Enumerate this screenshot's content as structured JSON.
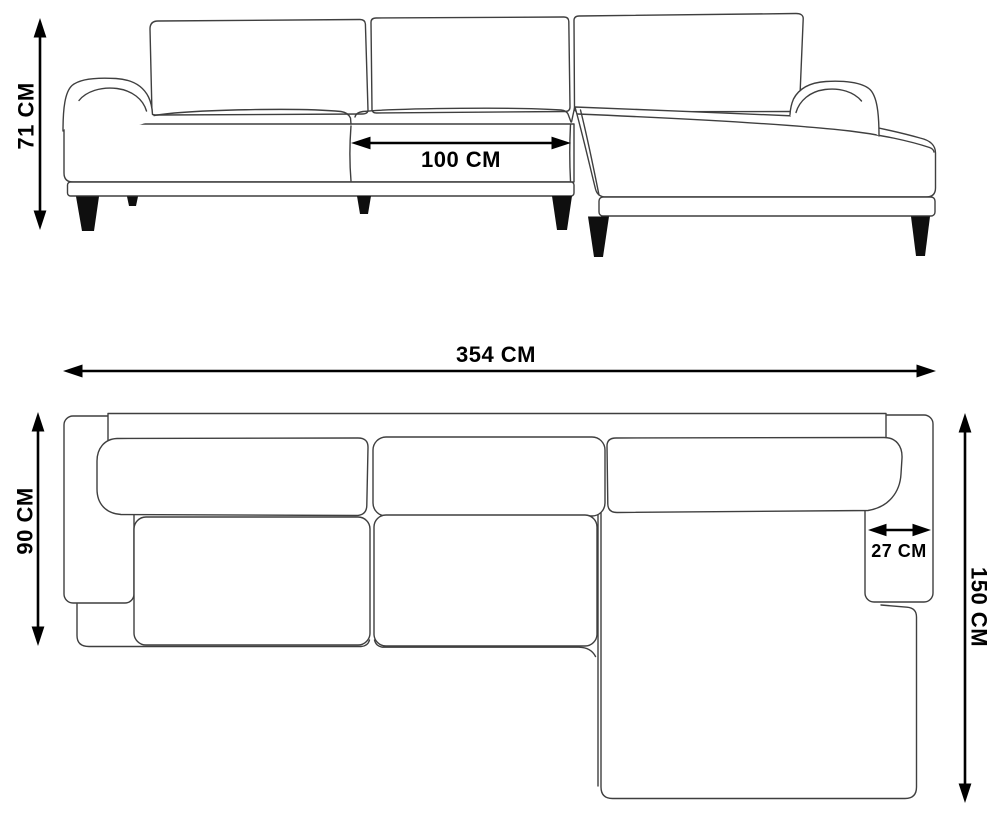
{
  "units": "CM",
  "dimensions": {
    "height": {
      "label": "71 CM",
      "value": 71,
      "unit": "CM",
      "view": "front-elevation"
    },
    "seat_width": {
      "label": "100 CM",
      "value": 100,
      "unit": "CM",
      "view": "front-elevation"
    },
    "total_width": {
      "label": "354 CM",
      "value": 354,
      "unit": "CM",
      "view": "top-plan"
    },
    "depth": {
      "label": "90 CM",
      "value": 90,
      "unit": "CM",
      "view": "top-plan"
    },
    "armrest_width": {
      "label": "27 CM",
      "value": 27,
      "unit": "CM",
      "view": "top-plan"
    },
    "chaise_depth": {
      "label": "150 CM",
      "value": 150,
      "unit": "CM",
      "view": "top-plan"
    }
  },
  "colors": {
    "background": "#ffffff",
    "line_art": "#3f3f3f",
    "dimension": "#000000",
    "legs": "#0f0f0f"
  }
}
